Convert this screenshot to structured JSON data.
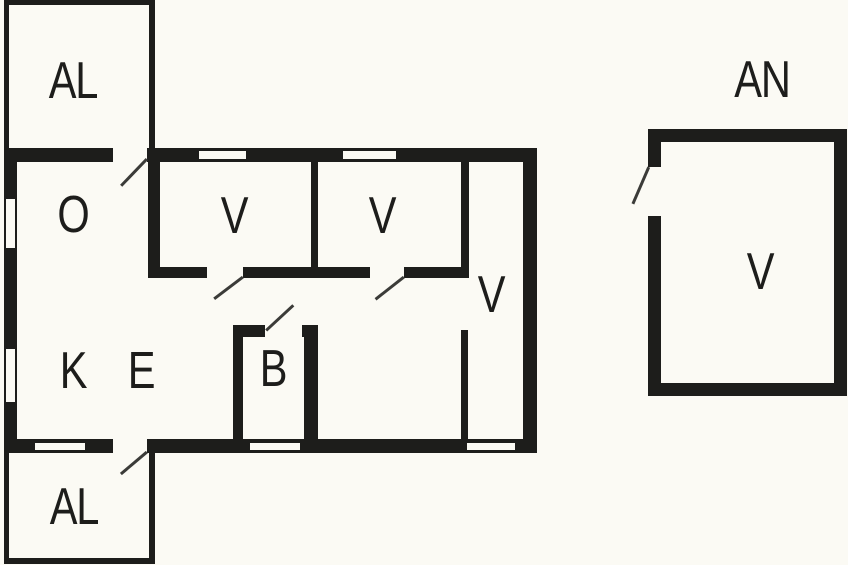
{
  "colors": {
    "background": "#fbfaf4",
    "wall": "#1d1d1b",
    "door_line": "#3b3b38",
    "text": "#1d1d1b"
  },
  "plan": {
    "labels": [
      {
        "text": "AL",
        "room": "annex-top"
      },
      {
        "text": "O",
        "room": "living-room"
      },
      {
        "text": "V",
        "room": "bedroom-1"
      },
      {
        "text": "V",
        "room": "bedroom-2"
      },
      {
        "text": "V",
        "room": "bedroom-3"
      },
      {
        "text": "K",
        "room": "kitchen"
      },
      {
        "text": "E",
        "room": "entry"
      },
      {
        "text": "B",
        "room": "bathroom"
      },
      {
        "text": "AL",
        "room": "annex-bottom"
      },
      {
        "text": "AN",
        "room": "outbuilding-title"
      },
      {
        "text": "V",
        "room": "outbuilding-room"
      }
    ],
    "walls": [
      {
        "name": "annex-top-wall-top",
        "x": 4,
        "y": 0,
        "w": 151,
        "h": 5
      },
      {
        "name": "annex-top-wall-left",
        "x": 4,
        "y": 0,
        "w": 5,
        "h": 148
      },
      {
        "name": "annex-top-wall-right",
        "x": 149,
        "y": 0,
        "w": 6,
        "h": 148
      },
      {
        "name": "main-top-wall-left",
        "x": 4,
        "y": 148,
        "w": 109,
        "h": 14
      },
      {
        "name": "main-top-wall-right",
        "x": 147,
        "y": 148,
        "w": 390,
        "h": 14
      },
      {
        "name": "main-left-wall",
        "x": 4,
        "y": 148,
        "w": 13,
        "h": 305
      },
      {
        "name": "main-right-wall",
        "x": 523,
        "y": 148,
        "w": 14,
        "h": 305
      },
      {
        "name": "main-bottom-wall-left",
        "x": 4,
        "y": 439,
        "w": 109,
        "h": 14
      },
      {
        "name": "main-bottom-wall-right",
        "x": 147,
        "y": 439,
        "w": 390,
        "h": 14
      },
      {
        "name": "wall-living-bedroom1",
        "x": 148,
        "y": 162,
        "w": 12,
        "h": 116
      },
      {
        "name": "wall-bedroom1-bedroom2",
        "x": 311,
        "y": 162,
        "w": 7,
        "h": 105
      },
      {
        "name": "wall-bedroom2-bedroom3",
        "x": 461,
        "y": 162,
        "w": 8,
        "h": 105
      },
      {
        "name": "wall-bedrooms-bottom-a",
        "x": 148,
        "y": 267,
        "w": 59,
        "h": 11
      },
      {
        "name": "wall-bedrooms-bottom-b",
        "x": 243,
        "y": 267,
        "w": 127,
        "h": 11
      },
      {
        "name": "wall-bedrooms-bottom-c",
        "x": 404,
        "y": 267,
        "w": 65,
        "h": 11
      },
      {
        "name": "wall-bedroom3-lower",
        "x": 461,
        "y": 330,
        "w": 7,
        "h": 109
      },
      {
        "name": "bath-top-wall-left",
        "x": 233,
        "y": 325,
        "w": 32,
        "h": 12
      },
      {
        "name": "bath-top-wall-right",
        "x": 302,
        "y": 325,
        "w": 16,
        "h": 12
      },
      {
        "name": "bath-left-wall",
        "x": 233,
        "y": 325,
        "w": 10,
        "h": 116
      },
      {
        "name": "bath-right-wall",
        "x": 304,
        "y": 325,
        "w": 14,
        "h": 116
      },
      {
        "name": "annex-bottom-wall-left",
        "x": 4,
        "y": 453,
        "w": 5,
        "h": 111
      },
      {
        "name": "annex-bottom-wall-right",
        "x": 149,
        "y": 453,
        "w": 6,
        "h": 111
      },
      {
        "name": "annex-bottom-wall-bottom",
        "x": 4,
        "y": 558,
        "w": 151,
        "h": 6
      },
      {
        "name": "outbuilding-top-wall",
        "x": 648,
        "y": 129,
        "w": 199,
        "h": 13
      },
      {
        "name": "outbuilding-right-wall",
        "x": 834,
        "y": 129,
        "w": 13,
        "h": 267
      },
      {
        "name": "outbuilding-bottom-wall",
        "x": 648,
        "y": 383,
        "w": 199,
        "h": 13
      },
      {
        "name": "outbuilding-left-wall-upper",
        "x": 648,
        "y": 129,
        "w": 13,
        "h": 38
      },
      {
        "name": "outbuilding-left-wall-lower",
        "x": 648,
        "y": 216,
        "w": 13,
        "h": 180
      }
    ],
    "windows": [
      {
        "name": "window-top-1",
        "x": 197,
        "y": 149,
        "w": 51,
        "h": 12
      },
      {
        "name": "window-top-2",
        "x": 341,
        "y": 149,
        "w": 57,
        "h": 12
      },
      {
        "name": "window-left-1",
        "x": 4,
        "y": 197,
        "w": 13,
        "h": 53
      },
      {
        "name": "window-left-2",
        "x": 4,
        "y": 347,
        "w": 13,
        "h": 57
      },
      {
        "name": "window-bottom-1",
        "x": 33,
        "y": 441,
        "w": 54,
        "h": 11
      },
      {
        "name": "window-bottom-2",
        "x": 248,
        "y": 441,
        "w": 54,
        "h": 11
      },
      {
        "name": "window-bottom-3",
        "x": 465,
        "y": 441,
        "w": 52,
        "h": 11
      }
    ],
    "doors": [
      {
        "name": "door-annex-top",
        "x1": 147,
        "y1": 159,
        "x2": 121,
        "y2": 186
      },
      {
        "name": "door-bedroom-1",
        "x1": 243,
        "y1": 277,
        "x2": 214,
        "y2": 299
      },
      {
        "name": "door-bedroom-2",
        "x1": 404,
        "y1": 277,
        "x2": 376,
        "y2": 299
      },
      {
        "name": "door-bathroom",
        "x1": 266,
        "y1": 330,
        "x2": 293,
        "y2": 305
      },
      {
        "name": "door-annex-bottom",
        "x1": 147,
        "y1": 452,
        "x2": 121,
        "y2": 474
      },
      {
        "name": "door-outbuilding",
        "x1": 649,
        "y1": 167,
        "x2": 633,
        "y2": 204
      }
    ]
  }
}
